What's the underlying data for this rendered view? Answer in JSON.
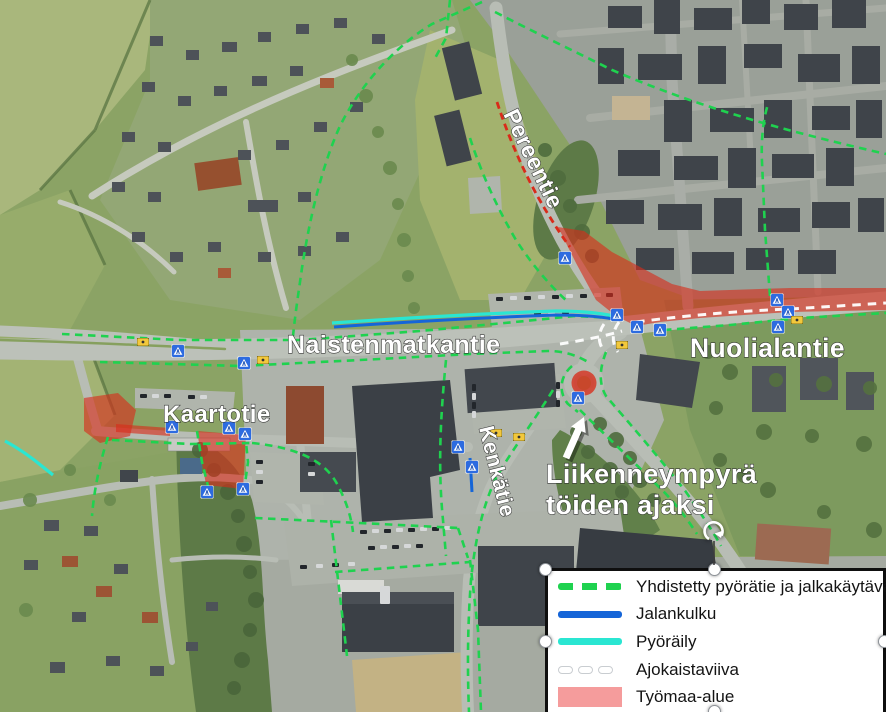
{
  "map": {
    "road_labels": [
      {
        "id": "naistenmatkantie",
        "text": "Naistenmatkantie"
      },
      {
        "id": "nuolialantie",
        "text": "Nuolialantie"
      },
      {
        "id": "pereentie",
        "text": "Pereentie"
      },
      {
        "id": "kaartotie",
        "text": "Kaartotie"
      },
      {
        "id": "kenkatie",
        "text": "Kenkätie"
      }
    ],
    "annotation": {
      "line1": "Liikenneympyrä",
      "line2": "töiden ajaksi"
    },
    "colors": {
      "combined_path_green": "#1fd24f",
      "pedestrian_blue": "#1565d8",
      "cycling_cyan": "#2ae6d2",
      "lane_marking_white": "#ffffff",
      "work_area_red": "#d92b1a",
      "work_area_pink": "#f59c9c",
      "crossing_sign_blue": "#2d6be0",
      "bus_stop_yellow": "#f2c83c"
    }
  },
  "legend": {
    "items": [
      {
        "label": "Yhdistetty pyörätie ja jalkakäytävä",
        "swatch": "green-dashed"
      },
      {
        "label": "Jalankulku",
        "swatch": "blue-solid"
      },
      {
        "label": "Pyöräily",
        "swatch": "cyan-solid"
      },
      {
        "label": "Ajokaistaviiva",
        "swatch": "white-dashed"
      },
      {
        "label": "Työmaa-alue",
        "swatch": "pink-fill"
      }
    ]
  }
}
